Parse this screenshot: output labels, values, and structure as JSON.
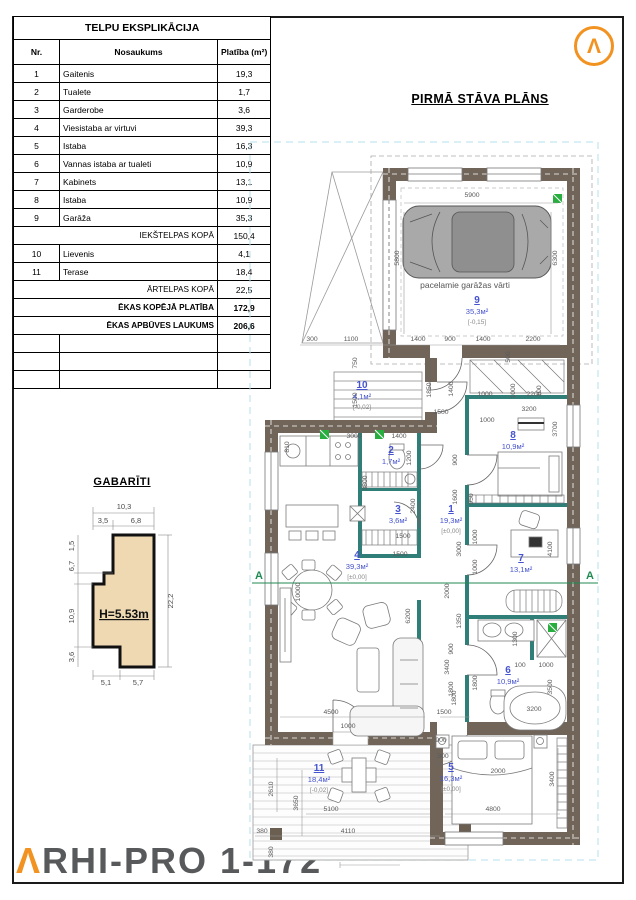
{
  "table": {
    "title": "TELPU EKSPLIKĀCIJA",
    "columns": [
      "Nr.",
      "Nosaukums",
      "Platība (m²)"
    ],
    "rows": [
      {
        "type": "item",
        "nr": "1",
        "name": "Gaitenis",
        "area": "19,3"
      },
      {
        "type": "item",
        "nr": "2",
        "name": "Tualete",
        "area": "1,7"
      },
      {
        "type": "item",
        "nr": "3",
        "name": "Garderobe",
        "area": "3,6"
      },
      {
        "type": "item",
        "nr": "4",
        "name": "Viesistaba ar virtuvi",
        "area": "39,3"
      },
      {
        "type": "item",
        "nr": "5",
        "name": "Istaba",
        "area": "16,3"
      },
      {
        "type": "item",
        "nr": "6",
        "name": "Vannas istaba ar tualeti",
        "area": "10,9"
      },
      {
        "type": "item",
        "nr": "7",
        "name": "Kabinets",
        "area": "13,1"
      },
      {
        "type": "item",
        "nr": "8",
        "name": "Istaba",
        "area": "10,9"
      },
      {
        "type": "item",
        "nr": "9",
        "name": "Garāža",
        "area": "35,3"
      },
      {
        "type": "sum",
        "name": "IEKŠTELPAS KOPĀ",
        "area": "150,4"
      },
      {
        "type": "item",
        "nr": "10",
        "name": "Lievenis",
        "area": "4,1"
      },
      {
        "type": "item",
        "nr": "11",
        "name": "Terase",
        "area": "18,4"
      },
      {
        "type": "sum",
        "name": "ĀRTELPAS KOPĀ",
        "area": "22,5"
      },
      {
        "type": "total",
        "name": "ĒKAS KOPĒJĀ PLATĪBA",
        "area": "172,9"
      },
      {
        "type": "total",
        "name": "ĒKAS APBŪVES LAUKUMS",
        "area": "206,6"
      },
      {
        "type": "empty"
      },
      {
        "type": "empty"
      },
      {
        "type": "empty"
      }
    ]
  },
  "plan": {
    "title": "PIRMĀ STĀVA PLĀNS",
    "garage_door_label": "pacelamie garāžas vārti",
    "section_letter": "A",
    "rooms": [
      {
        "n": "9",
        "a": "35,3м²",
        "l": "[-0,15]",
        "x": 477,
        "y": 303
      },
      {
        "n": "10",
        "a": "4,1м²",
        "l": "[-0,02]",
        "x": 362,
        "y": 388
      },
      {
        "n": "2",
        "a": "1,7м²",
        "l": "",
        "x": 391,
        "y": 453
      },
      {
        "n": "3",
        "a": "3,6м²",
        "l": "",
        "x": 398,
        "y": 512
      },
      {
        "n": "1",
        "a": "19,3м²",
        "l": "[±0,00]",
        "x": 451,
        "y": 512
      },
      {
        "n": "4",
        "a": "39,3м²",
        "l": "[±0,00]",
        "x": 357,
        "y": 558
      },
      {
        "n": "8",
        "a": "10,9м²",
        "l": "",
        "x": 513,
        "y": 438
      },
      {
        "n": "7",
        "a": "13,1м²",
        "l": "",
        "x": 521,
        "y": 561
      },
      {
        "n": "6",
        "a": "10,9м²",
        "l": "",
        "x": 508,
        "y": 673
      },
      {
        "n": "5",
        "a": "16,3м²",
        "l": "[±0,00]",
        "x": 451,
        "y": 770
      },
      {
        "n": "11",
        "a": "18,4м²",
        "l": "[-0,02]",
        "x": 319,
        "y": 771
      }
    ],
    "dims": [
      [
        "5900",
        472,
        197,
        0
      ],
      [
        "5800",
        399,
        258,
        1
      ],
      [
        "6300",
        557,
        258,
        1
      ],
      [
        "300",
        312,
        341,
        0
      ],
      [
        "1100",
        351,
        341,
        0
      ],
      [
        "1400",
        418,
        341,
        0
      ],
      [
        "900",
        450,
        341,
        0
      ],
      [
        "1400",
        483,
        341,
        0
      ],
      [
        "2200",
        533,
        341,
        0
      ],
      [
        "500",
        510,
        357,
        1
      ],
      [
        "100",
        541,
        391,
        1
      ],
      [
        "750",
        357,
        363,
        1
      ],
      [
        "1500",
        357,
        400,
        1
      ],
      [
        "1850",
        431,
        390,
        1
      ],
      [
        "1400",
        453,
        389,
        1
      ],
      [
        "1000",
        485,
        396,
        0
      ],
      [
        "1000",
        515,
        391,
        1
      ],
      [
        "2200",
        534,
        396,
        0
      ],
      [
        "3200",
        529,
        411,
        0
      ],
      [
        "1000",
        487,
        422,
        0
      ],
      [
        "1500",
        441,
        414,
        0
      ],
      [
        "3700",
        557,
        429,
        1
      ],
      [
        "3000",
        354,
        438,
        0
      ],
      [
        "1400",
        399,
        438,
        0
      ],
      [
        "810",
        289,
        447,
        1
      ],
      [
        "3800",
        367,
        483,
        1
      ],
      [
        "1200",
        411,
        458,
        1
      ],
      [
        "2400",
        415,
        506,
        1
      ],
      [
        "1500",
        403,
        538,
        0
      ],
      [
        "1500",
        400,
        556,
        0
      ],
      [
        "900",
        457,
        460,
        1
      ],
      [
        "1600",
        457,
        497,
        1
      ],
      [
        "10000",
        300,
        592,
        1
      ],
      [
        "6200",
        410,
        616,
        1
      ],
      [
        "2000",
        449,
        591,
        1
      ],
      [
        "3400",
        449,
        667,
        1
      ],
      [
        "1350",
        461,
        621,
        1
      ],
      [
        "950",
        473,
        499,
        1
      ],
      [
        "1000",
        477,
        537,
        1
      ],
      [
        "1000",
        477,
        567,
        1
      ],
      [
        "3000",
        461,
        549,
        1
      ],
      [
        "4100",
        552,
        549,
        1
      ],
      [
        "900",
        453,
        649,
        1
      ],
      [
        "1800",
        453,
        689,
        1
      ],
      [
        "1800",
        477,
        683,
        1
      ],
      [
        "1300",
        517,
        639,
        1
      ],
      [
        "100",
        520,
        667,
        0
      ],
      [
        "1000",
        546,
        667,
        0
      ],
      [
        "3500",
        552,
        687,
        1
      ],
      [
        "3200",
        534,
        711,
        0
      ],
      [
        "900",
        441,
        742,
        0
      ],
      [
        "300",
        443,
        758,
        0
      ],
      [
        "2000",
        498,
        773,
        0
      ],
      [
        "4800",
        493,
        811,
        0
      ],
      [
        "3400",
        554,
        779,
        1
      ],
      [
        "4500",
        331,
        714,
        0
      ],
      [
        "1000",
        348,
        728,
        0
      ],
      [
        "1500",
        444,
        714,
        0
      ],
      [
        "1800",
        456,
        698,
        1
      ],
      [
        "2610",
        273,
        789,
        1
      ],
      [
        "3650",
        298,
        803,
        1
      ],
      [
        "5100",
        331,
        811,
        0
      ],
      [
        "380",
        262,
        833,
        0
      ],
      [
        "4110",
        348,
        833,
        0
      ],
      [
        "380",
        273,
        852,
        1
      ]
    ]
  },
  "gabariti": {
    "title": "GABARĪTI",
    "height_label": "H=5.53m",
    "dims": [
      [
        "10,3",
        124,
        509,
        0
      ],
      [
        "3,5",
        103,
        523,
        0
      ],
      [
        "6,8",
        136,
        523,
        0
      ],
      [
        "22,2",
        173,
        601,
        1
      ],
      [
        "1,5",
        74,
        546,
        1
      ],
      [
        "6,7",
        74,
        566,
        1
      ],
      [
        "10,9",
        74,
        616,
        1
      ],
      [
        "3,6",
        74,
        657,
        1
      ],
      [
        "5,1",
        106,
        685,
        0
      ],
      [
        "5,7",
        138,
        685,
        0
      ]
    ]
  },
  "brand": {
    "lambda": "Λ",
    "rest": "RHI-PRO 1-172",
    "mark": "Λ"
  },
  "colors": {
    "wall": "#71655a",
    "partition": "#2f7e77",
    "room_label": "#4553cf",
    "dim": "#5a5a5a",
    "tan": "#eed9b3",
    "orange": "#f29220",
    "green": "#27ae3f",
    "section": "#1f8a52",
    "cyan": "#b5e0ee"
  }
}
